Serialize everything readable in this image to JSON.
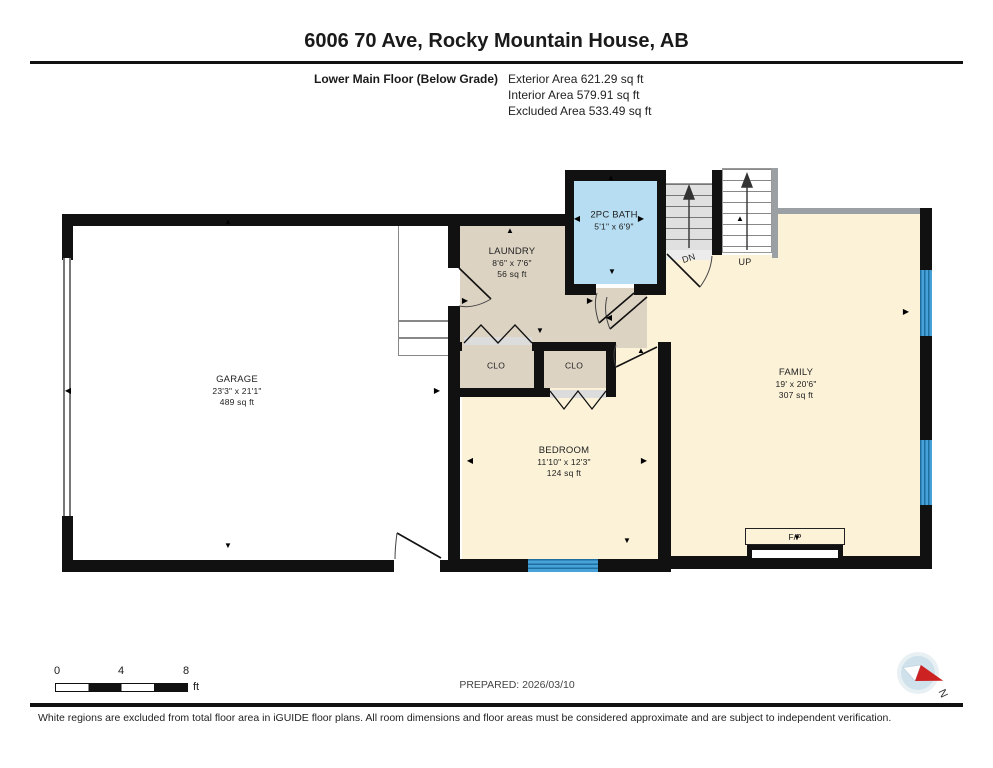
{
  "header": {
    "title": "6006 70 Ave, Rocky Mountain House, AB",
    "floor_label": "Lower Main Floor (Below Grade)",
    "exterior": "Exterior Area 621.29 sq ft",
    "interior": "Interior Area 579.91 sq ft",
    "excluded": "Excluded Area 533.49 sq ft"
  },
  "rooms": {
    "garage": {
      "name": "GARAGE",
      "dims": "23'3\" x 21'1\"",
      "area": "489 sq ft"
    },
    "laundry": {
      "name": "LAUNDRY",
      "dims": "8'6\" x 7'6\"",
      "area": "56 sq ft"
    },
    "bath": {
      "name": "2PC BATH",
      "dims": "5'1\" x 6'9\""
    },
    "bedroom": {
      "name": "BEDROOM",
      "dims": "11'10\" x 12'3\"",
      "area": "124 sq ft"
    },
    "family": {
      "name": "FAMILY",
      "dims": "19' x 20'6\"",
      "area": "307 sq ft"
    },
    "closet_left": {
      "name": "CLO"
    },
    "closet_right": {
      "name": "CLO"
    },
    "fireplace": {
      "name": "F/P"
    }
  },
  "stairs": {
    "down": "DN",
    "up": "UP"
  },
  "scale": {
    "t0": "0",
    "t4": "4",
    "t8": "8",
    "unit": "ft"
  },
  "prepared": "PREPARED: 2026/03/10",
  "compass": {
    "n": "N"
  },
  "footer": "White regions are excluded from total floor area in iGUIDE floor plans. All room dimensions and floor areas must be considered approximate and are subject to independent verification.",
  "colors": {
    "wall": "#111111",
    "tan_room": "#ddd3c3",
    "cream_room": "#fbf2d8",
    "bath_blue": "#b7ddf2",
    "window_blue": "#46a2d9",
    "stair_gray": "#e0e0e0",
    "compass_red": "#cc2222"
  }
}
